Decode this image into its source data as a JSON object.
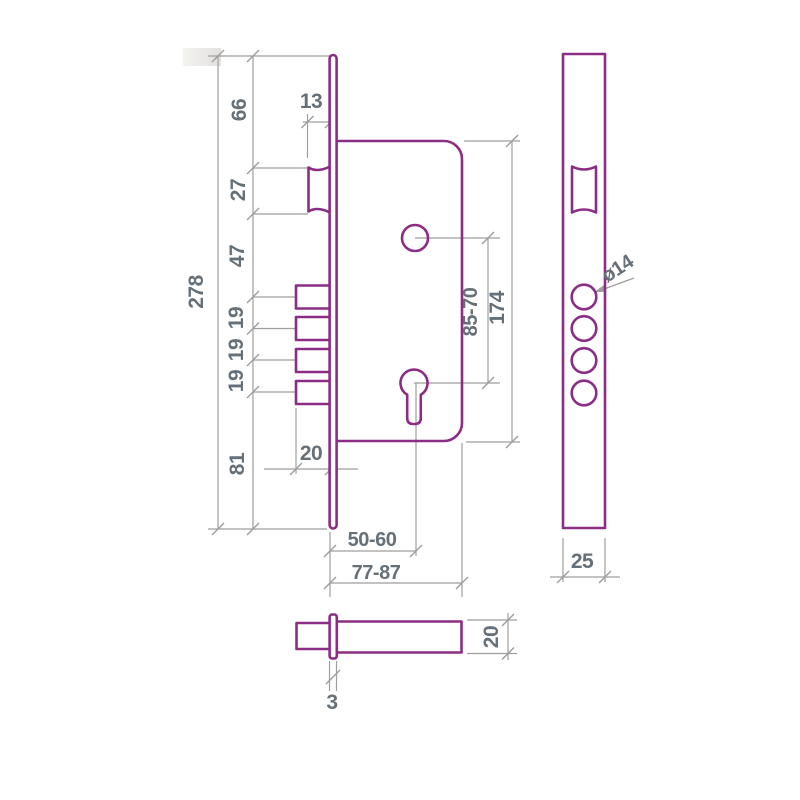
{
  "document": {
    "type": "technical-drawing",
    "subject": "mortise-lock"
  },
  "colors": {
    "outline": "#8b2d84",
    "dimension_lines": "#9e9e9e",
    "dimension_text": "#657078",
    "background": "#ffffff"
  },
  "dimensions": {
    "overall_height": "278",
    "top_to_latch": "66",
    "latch_height": "27",
    "latch_to_first_pin": "47",
    "pin_spacing_1": "19",
    "pin_spacing_2": "19",
    "pin_spacing_3": "19",
    "last_pin_to_bottom": "81",
    "latch_protrusion": "13",
    "pin_protrusion": "20",
    "spindle_to_cylinder": "85-70",
    "body_height": "174",
    "backset": "50-60",
    "body_depth": "77-87",
    "pin_hole_diameter": "ø14",
    "faceplate_width": "25",
    "body_thickness": "20",
    "faceplate_thickness": "3"
  }
}
